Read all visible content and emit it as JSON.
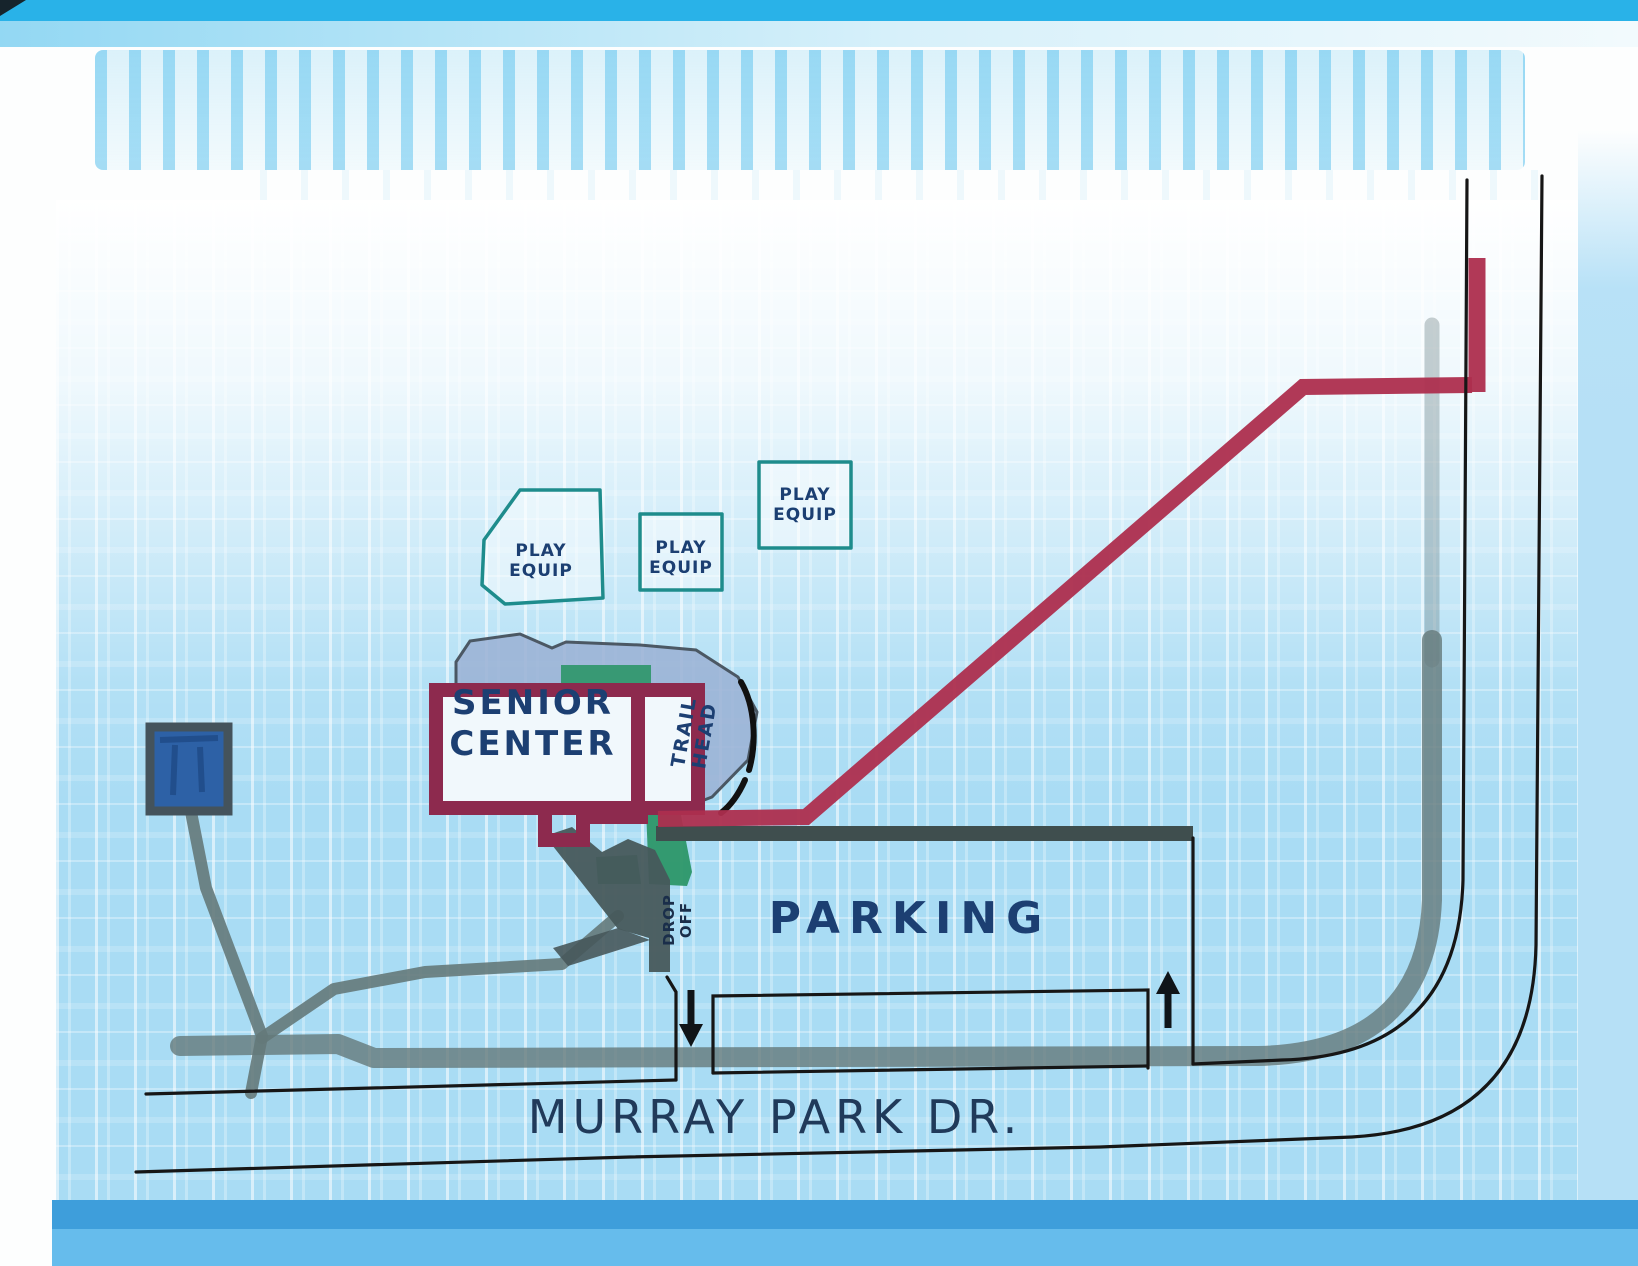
{
  "labels": {
    "senior_center": {
      "line1": "SENIOR",
      "line2": "CENTER"
    },
    "trail_head": {
      "line1": "TRAIL",
      "line2": "HEAD"
    },
    "drop_off": {
      "line1": "DROP",
      "line2": "OFF"
    },
    "parking": "PARKING",
    "street": "MURRAY PARK DR.",
    "play_areas": [
      {
        "line1": "PLAY",
        "line2": "EQUIP"
      },
      {
        "line1": "PLAY",
        "line2": "EQUIP"
      },
      {
        "line1": "PLAY",
        "line2": "EQUIP"
      }
    ]
  },
  "arrows": {
    "entrance_direction": "down",
    "exit_direction": "up"
  },
  "colors": {
    "ink": "#1c3f72",
    "maroon": "#8d2a4e",
    "red-trail": "#ad2e4e",
    "teal": "#1e8c8c",
    "road-band": "#64797a",
    "edge": "#161616",
    "plaza": "#9cb3d6",
    "plaza-edge": "#3c4550",
    "green": "#2c9668",
    "square-fill": "#2d61a6",
    "apron": "#47585b",
    "parking-band": "#3f4e4e",
    "cyan-top": "#29b2e8",
    "field-blue": "#a9dcf4",
    "bottom-band1": "#3e9edb",
    "bottom-band2": "#66bcec"
  }
}
